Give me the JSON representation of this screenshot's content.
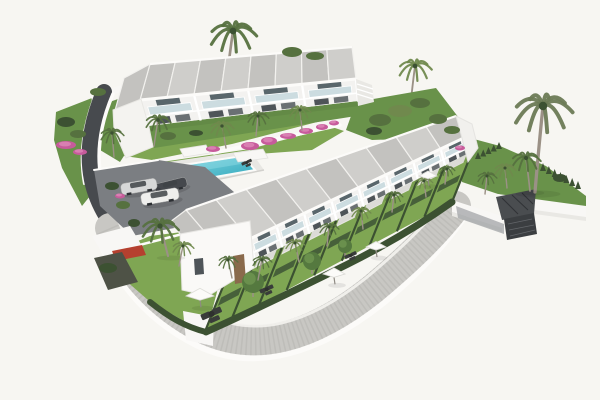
{
  "scene": {
    "type": "architectural-3d-render",
    "description": "Aerial 3D architectural rendering of a white modern townhouse complex on a hillside: an L-shaped layout with a rear two-storey block and a long row of terraced houses with grey mono-pitch roofs, glass balconies, private lawned gardens with parasols, a turquoise communal pool with pergolas, a small parking area with three cars, curving grey perimeter roads with white retaining walls, bougainvillea and many palm trees, on a plain white background.",
    "canvas": {
      "width": 600,
      "height": 400
    },
    "palette": {
      "bg": "#f7f6f2",
      "wall_white": "#f8f7f5",
      "wall_bright": "#faf9f7",
      "wall_shade": "#e9e8e4",
      "roof_light": "#cfcecb",
      "roof_dark": "#c3c2bf",
      "roof_line": "#f2f1ee",
      "glass": "#ccdce0",
      "glass_dark": "#59666b",
      "window_dark": "#4e5458",
      "lawn": "#7fa653",
      "lawn_dark": "#69924a",
      "hedge": "#3c5132",
      "hedge2": "#47603a",
      "palm": "#56713f",
      "palm_light": "#70894d",
      "palm_gray": "#6b7a55",
      "trunk": "#9b9186",
      "pool_shallow": "#8bdae4",
      "pool_deep": "#2aa4b9",
      "deck": "#e8e7e3",
      "road": "#474a4e",
      "asphalt": "#7b7e82",
      "pavement": "#c8c7c3",
      "pavement_speck": "#b2b1ad",
      "outer_wall": "#fcfbf9",
      "pink": "#c75b9b",
      "pink_light": "#e18ebc",
      "door_brown": "#8a6a4c",
      "car_silver": "#d7d8d8",
      "car_white": "#efefed",
      "car_dark": "#45484d",
      "furniture": "#393c3a",
      "gabion": "#3b3e41",
      "red_awning": "#b5402f"
    },
    "blocks": {
      "block_a": {
        "units": 4,
        "floors": 2
      },
      "block_b": {
        "units": 9,
        "floors": 2
      }
    },
    "pool": {
      "shallow": "#8bdae4",
      "deep": "#2aa4b9"
    },
    "palms": [
      {
        "x": 233,
        "y": 31,
        "s": 24,
        "t": 46,
        "lean": -3,
        "layer": "bg"
      },
      {
        "x": 415,
        "y": 66,
        "s": 17,
        "t": 34,
        "lean": -2,
        "layer": "bg",
        "c": "palm_light"
      },
      {
        "x": 130,
        "y": 110,
        "s": 16,
        "t": 34,
        "lean": 2,
        "layer": "bg"
      },
      {
        "x": 143,
        "y": 93,
        "s": 12,
        "t": 26,
        "lean": -2,
        "layer": "bg",
        "c": "palm_light"
      },
      {
        "x": 112,
        "y": 133,
        "s": 12,
        "t": 24,
        "lean": 1,
        "layer": "fg"
      },
      {
        "x": 158,
        "y": 120,
        "s": 13,
        "t": 26,
        "lean": -2,
        "layer": "fg"
      },
      {
        "x": 222,
        "y": 126,
        "s": 12,
        "t": 22,
        "lean": 2,
        "layer": "fg",
        "c": "palm_light"
      },
      {
        "x": 258,
        "y": 116,
        "s": 11,
        "t": 20,
        "lean": -1,
        "layer": "fg"
      },
      {
        "x": 300,
        "y": 110,
        "s": 11,
        "t": 20,
        "lean": 1,
        "layer": "fg",
        "c": "palm_light"
      },
      {
        "x": 543,
        "y": 106,
        "s": 30,
        "t": 86,
        "lean": -4,
        "layer": "fg",
        "c": "palm_gray"
      },
      {
        "x": 526,
        "y": 158,
        "s": 15,
        "t": 33,
        "lean": 2,
        "layer": "fg"
      },
      {
        "x": 487,
        "y": 176,
        "s": 10,
        "t": 18,
        "lean": -1,
        "layer": "fg"
      },
      {
        "x": 505,
        "y": 168,
        "s": 11,
        "t": 20,
        "lean": 1,
        "layer": "fg",
        "c": "palm_light"
      },
      {
        "x": 262,
        "y": 260,
        "s": 10,
        "t": 20,
        "lean": -2,
        "layer": "fg"
      },
      {
        "x": 295,
        "y": 243,
        "s": 10,
        "t": 19,
        "lean": 2,
        "layer": "fg",
        "c": "palm_light"
      },
      {
        "x": 329,
        "y": 227,
        "s": 10,
        "t": 19,
        "lean": -1,
        "layer": "fg"
      },
      {
        "x": 361,
        "y": 211,
        "s": 10,
        "t": 18,
        "lean": 1,
        "layer": "fg",
        "c": "palm_light"
      },
      {
        "x": 394,
        "y": 195,
        "s": 9,
        "t": 17,
        "lean": -1,
        "layer": "fg"
      },
      {
        "x": 424,
        "y": 181,
        "s": 9,
        "t": 16,
        "lean": 1,
        "layer": "fg",
        "c": "palm_light"
      },
      {
        "x": 447,
        "y": 169,
        "s": 8,
        "t": 15,
        "lean": -1,
        "layer": "fg"
      },
      {
        "x": 228,
        "y": 260,
        "s": 10,
        "t": 18,
        "lean": 2,
        "layer": "fg"
      },
      {
        "x": 160,
        "y": 226,
        "s": 19,
        "t": 30,
        "lean": 4,
        "layer": "fg"
      },
      {
        "x": 183,
        "y": 246,
        "s": 11,
        "t": 20,
        "lean": -2,
        "layer": "fg",
        "c": "palm_light"
      }
    ],
    "round_trees": [
      {
        "x": 253,
        "y": 282,
        "r": 11
      },
      {
        "x": 312,
        "y": 261,
        "r": 9
      },
      {
        "x": 345,
        "y": 246,
        "r": 7
      }
    ],
    "bushes": [
      {
        "x": 292,
        "y": 52,
        "rx": 10,
        "ry": 5
      },
      {
        "x": 315,
        "y": 56,
        "rx": 9,
        "ry": 4
      },
      {
        "x": 380,
        "y": 120,
        "rx": 11,
        "ry": 6
      },
      {
        "x": 400,
        "y": 111,
        "rx": 12,
        "ry": 6,
        "c": "palm_light"
      },
      {
        "x": 420,
        "y": 103,
        "rx": 10,
        "ry": 5
      },
      {
        "x": 438,
        "y": 119,
        "rx": 9,
        "ry": 5
      },
      {
        "x": 374,
        "y": 131,
        "rx": 8,
        "ry": 4,
        "c": "hedge"
      },
      {
        "x": 98,
        "y": 92,
        "rx": 8,
        "ry": 4
      },
      {
        "x": 66,
        "y": 122,
        "rx": 9,
        "ry": 5,
        "c": "hedge"
      },
      {
        "x": 78,
        "y": 134,
        "rx": 8,
        "ry": 4
      },
      {
        "x": 112,
        "y": 186,
        "rx": 7,
        "ry": 4,
        "c": "hedge"
      },
      {
        "x": 123,
        "y": 205,
        "rx": 7,
        "ry": 4
      },
      {
        "x": 134,
        "y": 223,
        "rx": 6,
        "ry": 4,
        "c": "hedge"
      },
      {
        "x": 168,
        "y": 136,
        "rx": 8,
        "ry": 4
      },
      {
        "x": 196,
        "y": 133,
        "rx": 7,
        "ry": 3,
        "c": "hedge"
      },
      {
        "x": 452,
        "y": 130,
        "rx": 8,
        "ry": 4
      },
      {
        "x": 560,
        "y": 178,
        "rx": 7,
        "ry": 4,
        "c": "hedge"
      },
      {
        "x": 108,
        "y": 268,
        "rx": 9,
        "ry": 5,
        "c": "hedge"
      }
    ],
    "flowers": [
      {
        "x": 250,
        "y": 146,
        "rx": 9,
        "ry": 4
      },
      {
        "x": 269,
        "y": 141,
        "rx": 8,
        "ry": 4
      },
      {
        "x": 288,
        "y": 136,
        "rx": 8,
        "ry": 3
      },
      {
        "x": 306,
        "y": 131,
        "rx": 7,
        "ry": 3
      },
      {
        "x": 322,
        "y": 127,
        "rx": 6,
        "ry": 3
      },
      {
        "x": 334,
        "y": 123,
        "rx": 5,
        "ry": 2.5
      },
      {
        "x": 213,
        "y": 149,
        "rx": 7,
        "ry": 3
      },
      {
        "x": 66,
        "y": 145,
        "rx": 10,
        "ry": 4
      },
      {
        "x": 80,
        "y": 152,
        "rx": 7,
        "ry": 3
      },
      {
        "x": 120,
        "y": 196,
        "rx": 5,
        "ry": 2.5
      },
      {
        "x": 460,
        "y": 148,
        "rx": 5,
        "ry": 2.5
      }
    ],
    "parasols": [
      {
        "x": 200,
        "y": 296,
        "s": 14
      },
      {
        "x": 334,
        "y": 274,
        "s": 11
      },
      {
        "x": 376,
        "y": 247,
        "s": 10
      },
      {
        "x": 428,
        "y": 176,
        "s": 9
      }
    ],
    "furniture": [
      {
        "x": 212,
        "y": 315,
        "s": 1.2
      },
      {
        "x": 267,
        "y": 290,
        "s": 0.8
      },
      {
        "x": 351,
        "y": 256,
        "s": 0.7
      },
      {
        "x": 247,
        "y": 163,
        "s": 0.6
      }
    ],
    "cars": [
      {
        "x": 171,
        "y": 186,
        "r": -14,
        "s": 0.85,
        "c": "car_dark"
      },
      {
        "x": 139,
        "y": 187,
        "r": -10,
        "s": 0.95,
        "c": "car_silver"
      },
      {
        "x": 160,
        "y": 197,
        "r": -10,
        "s": 1.0,
        "c": "car_white"
      }
    ],
    "hedge_rows": [
      {
        "x1": 543,
        "y1": 171,
        "x2": 578,
        "y2": 189,
        "n": 7,
        "h": 8
      },
      {
        "x1": 478,
        "y1": 159,
        "x2": 499,
        "y2": 149,
        "n": 5,
        "h": 7
      }
    ]
  }
}
